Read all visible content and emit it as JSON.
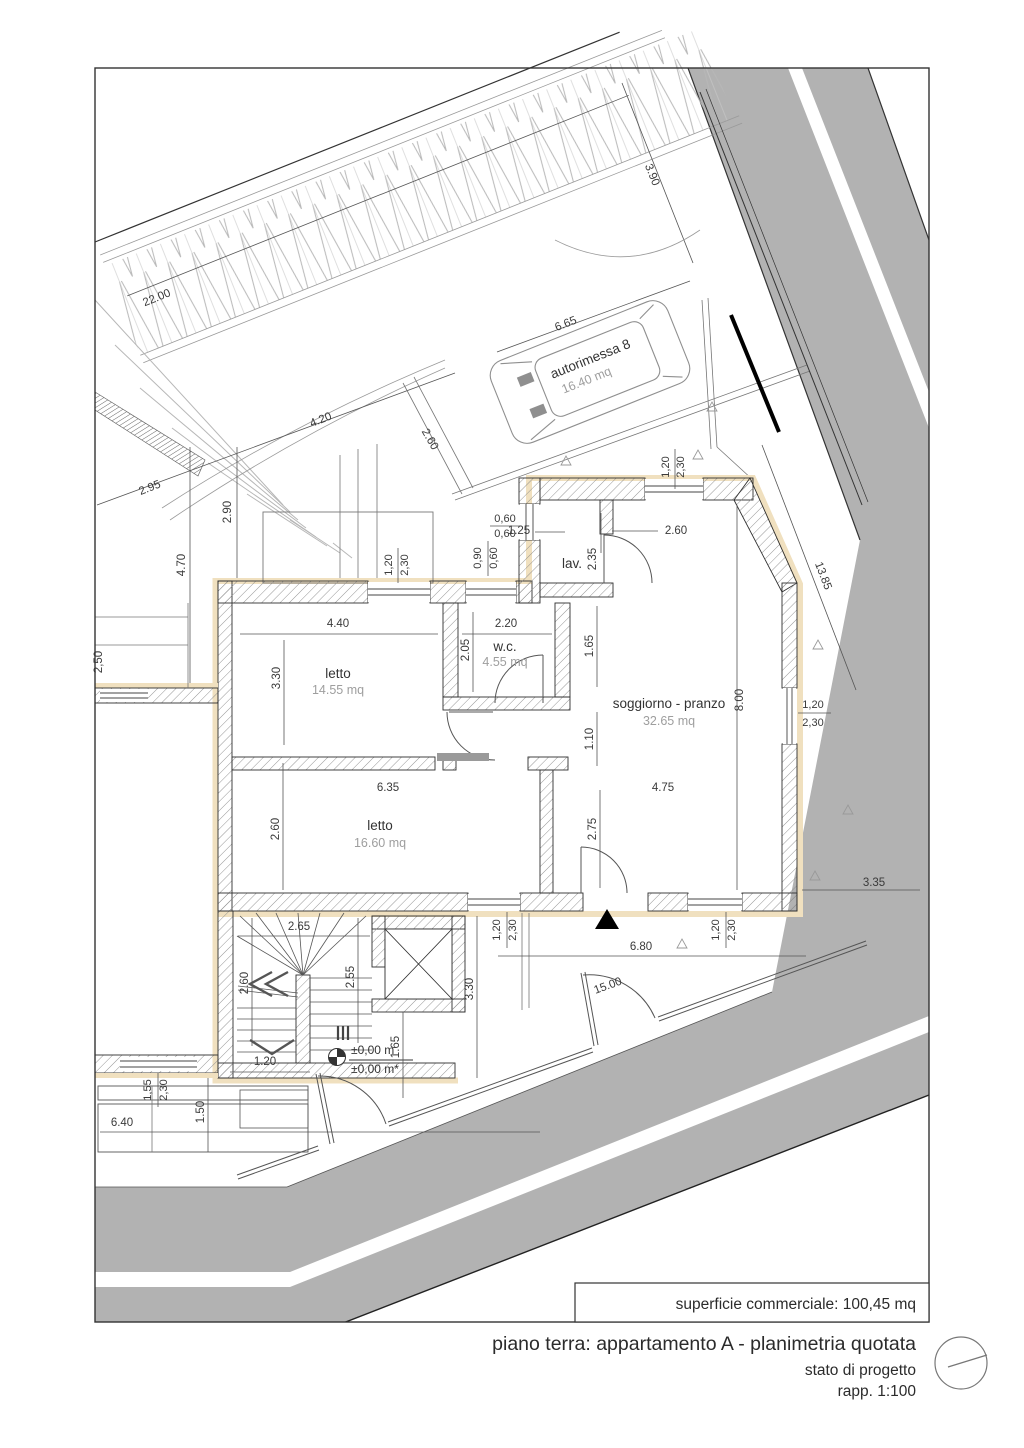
{
  "drawing": {
    "surface_note": "superficie commerciale: 100,45 mq",
    "title": "piano terra: appartamento A - planimetria quotata",
    "subtitle": "stato di progetto",
    "scale": "rapp. 1:100"
  },
  "rooms": {
    "garage": {
      "label": "autorimessa 8",
      "area": "16.40 mq"
    },
    "letto1": {
      "label": "letto",
      "area": "14.55 mq"
    },
    "wc": {
      "label": "w.c.",
      "area": "4.55 mq"
    },
    "lav": {
      "label": "lav."
    },
    "soggiorno": {
      "label": "soggiorno - pranzo",
      "area": "32.65 mq"
    },
    "letto2": {
      "label": "letto",
      "area": "16.60 mq"
    }
  },
  "level_marker": {
    "value": "±0,00 m",
    "value2": "±0,00 m*"
  },
  "dims": [
    "22.00",
    "2.95",
    "4.20",
    "2.60",
    "2.90",
    "4.70",
    "6.65",
    "3.90",
    "1.25",
    "2.60",
    "0,60",
    "0,60",
    "0,90",
    "0,60",
    "2.35",
    "1,20",
    "2,30",
    "13.85",
    "4.40",
    "2.20",
    "3.30",
    "2.05",
    "1.65",
    "1.10",
    "8.00",
    "1,20",
    "2,30",
    "6.35",
    "4.75",
    "2.60",
    "2.75",
    "3.35",
    "1,20",
    "2,30",
    "1,20",
    "2,30",
    "6.80",
    "15.00",
    "2.65",
    "2.60",
    "2.55",
    "3.30",
    "1.65",
    "1.20",
    "1,55",
    "2,30",
    "1.50",
    "6.40",
    "2,50",
    "1,20",
    "2,30"
  ],
  "colors": {
    "wall_accent": "#f0e0bf",
    "road": "#b2b2b2",
    "hatch_line": "#8a8a8a"
  }
}
